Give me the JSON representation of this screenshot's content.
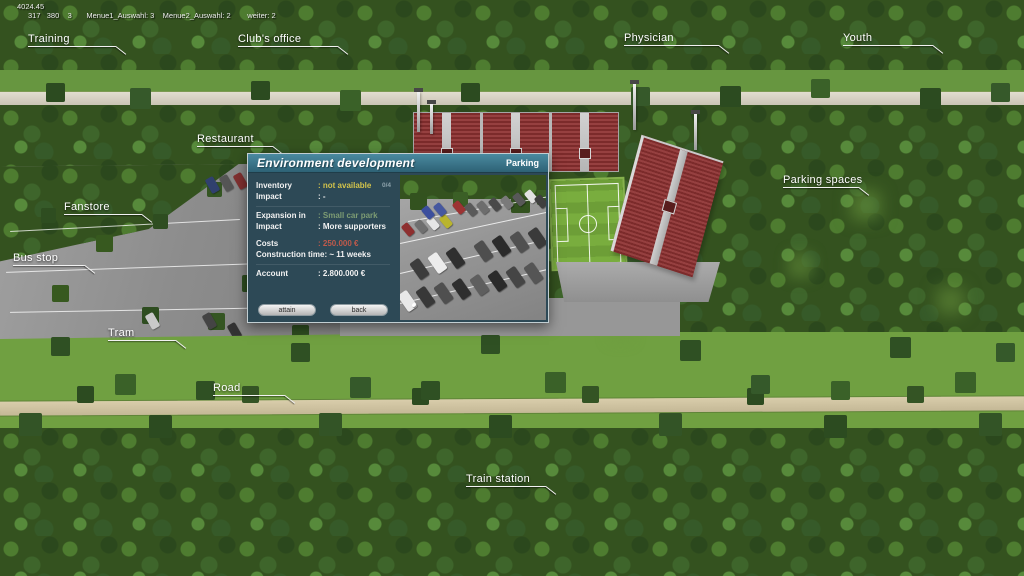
{
  "debug": {
    "line1": "4024.45",
    "line2": "317   380    3       Menue1_Auswahl: 3    Menue2_Auswahl: 2        weiter: 2"
  },
  "map_labels": [
    {
      "label": "Training"
    },
    {
      "label": "Club's office"
    },
    {
      "label": "Physician"
    },
    {
      "label": "Youth"
    },
    {
      "label": "Restaurant"
    },
    {
      "label": "Parking spaces"
    },
    {
      "label": "Fanstore"
    },
    {
      "label": "Bus stop"
    },
    {
      "label": "Tram"
    },
    {
      "label": "Road"
    },
    {
      "label": "Train station"
    }
  ],
  "dialog": {
    "title": "Environment development",
    "category": "Parking",
    "inventory": {
      "label": "Inventory",
      "value": ": not available",
      "count": "0/4"
    },
    "impact_current": {
      "label": "Impact",
      "value": ": -"
    },
    "expansion": {
      "label": "Expansion in",
      "value": ": Small car park"
    },
    "impact_new": {
      "label": "Impact",
      "value": ": More supporters"
    },
    "costs": {
      "label": "Costs",
      "value": ": 250.000 €"
    },
    "construction": {
      "label": "Construction time",
      "value": ": ~ 11 weeks"
    },
    "account": {
      "label": "Account",
      "value": ": 2.800.000 €"
    },
    "buttons": {
      "attain": "attain",
      "back": "back"
    }
  },
  "colors": {
    "value_unavailable": "#d3c34b",
    "value_expansion": "#7d9c73",
    "value_costs": "#bf5a4b",
    "dialog_body": "#2d4956",
    "dialog_header": "#3a7489"
  }
}
